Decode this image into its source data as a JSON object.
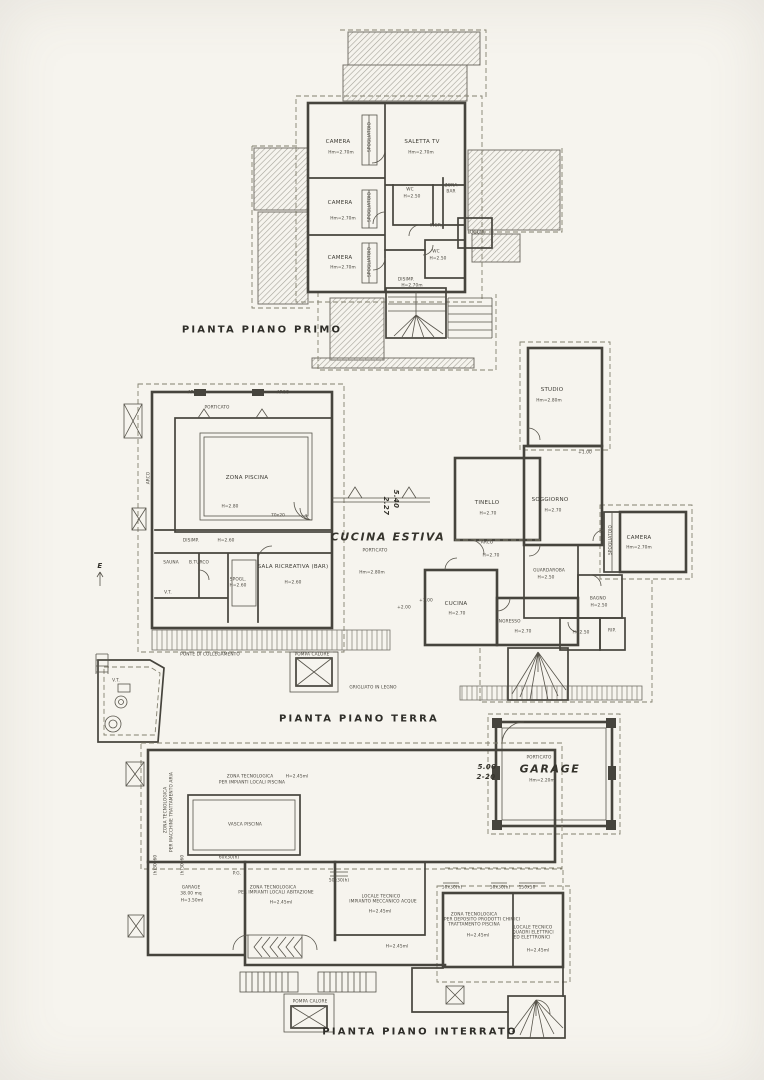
{
  "sheet": {
    "kind": "scanned architectural floor plan drawing",
    "colors": {
      "paper": "#f6f4ee",
      "ink": "#46443d",
      "dash": "#83806f",
      "hatch": "#a5a299"
    }
  },
  "plans": {
    "primo": {
      "title": "PIANTA PIANO PRIMO",
      "labels": [
        {
          "n": "room-camera-1",
          "t": "CAMERA",
          "x": 338,
          "y": 142
        },
        {
          "n": "room-camera-1-height",
          "t": "Hm=2.70m",
          "x": 341,
          "y": 153,
          "cls": "t4"
        },
        {
          "n": "room-saletta-tv",
          "t": "SALETTA  TV",
          "x": 422,
          "y": 142
        },
        {
          "n": "room-saletta-tv-height",
          "t": "Hm=2.70m",
          "x": 421,
          "y": 153,
          "cls": "t4"
        },
        {
          "n": "room-spogliatoio-1",
          "t": "SPOGLIATOIO",
          "x": 370,
          "y": 137,
          "cls": "t4",
          "r": -90
        },
        {
          "n": "room-camera-2",
          "t": "CAMERA",
          "x": 340,
          "y": 203
        },
        {
          "n": "room-camera-2-height",
          "t": "Hm=2.70m",
          "x": 343,
          "y": 219,
          "cls": "t4"
        },
        {
          "n": "room-spogliatoio-2",
          "t": "SPOGLIATOIO",
          "x": 370,
          "y": 207,
          "cls": "t4",
          "r": -90
        },
        {
          "n": "room-wc-1",
          "t": "WC",
          "x": 410,
          "y": 190,
          "cls": "t4"
        },
        {
          "n": "room-wc-1-height",
          "t": "H=2.50",
          "x": 412,
          "y": 197,
          "cls": "t4"
        },
        {
          "n": "room-zona-bar-1",
          "t": "ZONA",
          "x": 451,
          "y": 186,
          "cls": "t4"
        },
        {
          "n": "room-zona-bar-2",
          "t": "BAR",
          "x": 451,
          "y": 192,
          "cls": "t4"
        },
        {
          "n": "room-ingr",
          "t": "INGR.",
          "x": 436,
          "y": 226,
          "cls": "t4"
        },
        {
          "n": "room-loggia",
          "t": "LOGGIA",
          "x": 476,
          "y": 233,
          "cls": "t4"
        },
        {
          "n": "room-camera-3",
          "t": "CAMERA",
          "x": 340,
          "y": 258
        },
        {
          "n": "room-camera-3-height",
          "t": "Hm=2.70m",
          "x": 343,
          "y": 268,
          "cls": "t4"
        },
        {
          "n": "room-spogliatoio-3",
          "t": "SPOGLIATOIO",
          "x": 370,
          "y": 262,
          "cls": "t4",
          "r": -90
        },
        {
          "n": "room-wc-2",
          "t": "WC",
          "x": 436,
          "y": 252,
          "cls": "t4"
        },
        {
          "n": "room-wc-2-height",
          "t": "H=2.50",
          "x": 438,
          "y": 259,
          "cls": "t4"
        },
        {
          "n": "room-disimp",
          "t": "DISIMP.",
          "x": 406,
          "y": 280,
          "cls": "t4"
        },
        {
          "n": "room-disimp-height",
          "t": "H=2.70m",
          "x": 412,
          "y": 286,
          "cls": "t4"
        }
      ]
    },
    "terra": {
      "title": "PIANTA PIANO TERRA",
      "labels": [
        {
          "n": "note-arco-1",
          "t": "ARCO",
          "x": 194,
          "y": 393,
          "cls": "t4"
        },
        {
          "n": "note-arco-2",
          "t": "ARCO",
          "x": 283,
          "y": 393,
          "cls": "t4"
        },
        {
          "n": "note-arco-left",
          "t": "ARCO",
          "x": 149,
          "y": 478,
          "cls": "t4",
          "r": -90
        },
        {
          "n": "note-porticato-piscina",
          "t": "PORTICATO",
          "x": 217,
          "y": 408,
          "cls": "t4"
        },
        {
          "n": "room-zona-piscina",
          "t": "ZONA PISCINA",
          "x": 247,
          "y": 478
        },
        {
          "n": "room-zona-piscina-height",
          "t": "H=2.80",
          "x": 230,
          "y": 507,
          "cls": "t4"
        },
        {
          "n": "dim-pool-step",
          "t": "70x20",
          "x": 278,
          "y": 516,
          "cls": "t4"
        },
        {
          "n": "room-disimp-terra",
          "t": "DISIMP.",
          "x": 191,
          "y": 541,
          "cls": "t4"
        },
        {
          "n": "room-disimp-terra-height",
          "t": "H=2.60",
          "x": 226,
          "y": 541,
          "cls": "t4"
        },
        {
          "n": "room-sauna",
          "t": "SAUNA",
          "x": 171,
          "y": 563,
          "cls": "t4"
        },
        {
          "n": "room-bagno-turco",
          "t": "B.TURCO",
          "x": 199,
          "y": 563,
          "cls": "t4"
        },
        {
          "n": "room-spogl",
          "t": "SPOGL.",
          "x": 238,
          "y": 580,
          "cls": "t4"
        },
        {
          "n": "room-spogl-height",
          "t": "H=2.60",
          "x": 238,
          "y": 586,
          "cls": "t4"
        },
        {
          "n": "room-sala-ricreativa",
          "t": "SALA  RICREATIVA  (BAR)",
          "x": 293,
          "y": 567
        },
        {
          "n": "room-sala-ricreativa-height",
          "t": "H=2.60",
          "x": 293,
          "y": 583,
          "cls": "t4"
        },
        {
          "n": "note-vt-locale",
          "t": "V.T.",
          "x": 168,
          "y": 593,
          "cls": "t4"
        },
        {
          "n": "note-ponte",
          "t": "PONTE  DI  COLLEGAMENTO",
          "x": 210,
          "y": 655,
          "cls": "t4"
        },
        {
          "n": "note-vt-outbuilding",
          "t": "V.T.",
          "x": 116,
          "y": 681,
          "cls": "t4"
        },
        {
          "n": "hand-cucina-estiva",
          "t": "CUCINA ESTIVA",
          "x": 388,
          "y": 537,
          "cls": "hand"
        },
        {
          "n": "note-porticato-cucina",
          "t": "PORTICATO",
          "x": 375,
          "y": 551,
          "cls": "t4"
        },
        {
          "n": "note-porticato-cucina-height",
          "t": "Hm=2.80m",
          "x": 372,
          "y": 573,
          "cls": "t4"
        },
        {
          "n": "hand-dim-540",
          "t": "5.40",
          "x": 396,
          "y": 499,
          "cls": "hand-s",
          "r": 90
        },
        {
          "n": "hand-dim-227",
          "t": "2.27",
          "x": 386,
          "y": 506,
          "cls": "hand-s",
          "r": 90
        },
        {
          "n": "room-tinello",
          "t": "TINELLO",
          "x": 487,
          "y": 503
        },
        {
          "n": "room-tinello-height",
          "t": "H=2.70",
          "x": 488,
          "y": 514,
          "cls": "t4"
        },
        {
          "n": "note-arco-tinello",
          "t": "ARCO",
          "x": 487,
          "y": 543,
          "cls": "t4"
        },
        {
          "n": "note-arco-tinello-height",
          "t": "H=2.70",
          "x": 491,
          "y": 556,
          "cls": "t4"
        },
        {
          "n": "room-studio",
          "t": "STUDIO",
          "x": 552,
          "y": 390
        },
        {
          "n": "room-studio-height",
          "t": "Hm=2.80m",
          "x": 549,
          "y": 401,
          "cls": "t4"
        },
        {
          "n": "room-soggiorno",
          "t": "SOGGIORNO",
          "x": 550,
          "y": 500
        },
        {
          "n": "room-soggiorno-height",
          "t": "H=2.70",
          "x": 553,
          "y": 511,
          "cls": "t4"
        },
        {
          "n": "room-camera-terra",
          "t": "CAMERA",
          "x": 639,
          "y": 538
        },
        {
          "n": "room-camera-terra-height",
          "t": "Hm=2.70m",
          "x": 639,
          "y": 548,
          "cls": "t4"
        },
        {
          "n": "room-spogliatoio-terra",
          "t": "SPOGLIATOIO",
          "x": 611,
          "y": 540,
          "cls": "t4",
          "r": -90
        },
        {
          "n": "room-guardaroba",
          "t": "GUARDAROBA",
          "x": 549,
          "y": 571,
          "cls": "t4"
        },
        {
          "n": "room-guardaroba-height",
          "t": "H=2.50",
          "x": 546,
          "y": 578,
          "cls": "t4"
        },
        {
          "n": "room-bagno",
          "t": "BAGNO",
          "x": 598,
          "y": 599,
          "cls": "t4"
        },
        {
          "n": "room-bagno-height",
          "t": "H=2.50",
          "x": 599,
          "y": 606,
          "cls": "t4"
        },
        {
          "n": "room-wc-terra-height",
          "t": "H=2.50",
          "x": 581,
          "y": 633,
          "cls": "t4"
        },
        {
          "n": "room-rip",
          "t": "RIP.",
          "x": 612,
          "y": 631,
          "cls": "t4"
        },
        {
          "n": "room-cucina",
          "t": "CUCINA",
          "x": 456,
          "y": 604
        },
        {
          "n": "room-cucina-height",
          "t": "H=2.70",
          "x": 457,
          "y": 614,
          "cls": "t4"
        },
        {
          "n": "room-ingresso",
          "t": "INGRESSO",
          "x": 509,
          "y": 622,
          "cls": "t4"
        },
        {
          "n": "room-ingresso-height",
          "t": "H=2.70",
          "x": 523,
          "y": 632,
          "cls": "t4"
        },
        {
          "n": "level-plus-100",
          "t": "+1.00",
          "x": 426,
          "y": 601,
          "cls": "t4"
        },
        {
          "n": "level-plus-200",
          "t": "+2.00",
          "x": 404,
          "y": 608,
          "cls": "t4"
        },
        {
          "n": "level-plus-100-b",
          "t": "+1.00",
          "x": 585,
          "y": 453,
          "cls": "t4"
        },
        {
          "n": "note-pompa-calore",
          "t": "POMPA CALORE",
          "x": 312,
          "y": 655,
          "cls": "t4"
        },
        {
          "n": "note-grigliato",
          "t": "GRIGLIATO  IN  LEGNO",
          "x": 373,
          "y": 688,
          "cls": "t4"
        },
        {
          "n": "hand-east-mark",
          "t": "E",
          "x": 100,
          "y": 566,
          "cls": "hand-s"
        },
        {
          "n": "note-porticato-garage",
          "t": "PORTICATO",
          "x": 539,
          "y": 758,
          "cls": "t4"
        },
        {
          "n": "hand-garage",
          "t": "GARAGE",
          "x": 550,
          "y": 769,
          "cls": "hand"
        },
        {
          "n": "note-garage-height",
          "t": "Hm=2.20m",
          "x": 542,
          "y": 781,
          "cls": "t4"
        },
        {
          "n": "hand-dim-500",
          "t": "5.00",
          "x": 487,
          "y": 767,
          "cls": "hand-s"
        },
        {
          "n": "hand-dim-220",
          "t": "2-20",
          "x": 486,
          "y": 777,
          "cls": "hand-s"
        }
      ]
    },
    "interrato": {
      "title": "PIANTA PIANO INTERRATO",
      "labels": [
        {
          "n": "room-zt-piscina-1",
          "t": "ZONA TECNOLOGICA",
          "x": 250,
          "y": 777,
          "cls": "t4"
        },
        {
          "n": "room-zt-piscina-2",
          "t": "PER IMPIANTI LOCALI PISCINA",
          "x": 252,
          "y": 783,
          "cls": "t4"
        },
        {
          "n": "room-zt-piscina-height",
          "t": "H=2.45ml",
          "x": 297,
          "y": 777,
          "cls": "t4"
        },
        {
          "n": "room-vasca-piscina",
          "t": "VASCA  PISCINA",
          "x": 245,
          "y": 825,
          "cls": "t4"
        },
        {
          "n": "room-zt-aria-1",
          "t": "ZONA TECNOLOGICA",
          "x": 166,
          "y": 810,
          "cls": "t4",
          "r": -90
        },
        {
          "n": "room-zt-aria-2",
          "t": "PER MACCHINE TRATTAMENTO ARIA",
          "x": 172,
          "y": 812,
          "cls": "t4",
          "r": -90
        },
        {
          "n": "room-garage-interrato",
          "t": "GARAGE",
          "x": 191,
          "y": 888,
          "cls": "t4"
        },
        {
          "n": "room-garage-interrato-mq",
          "t": "38.00 mq",
          "x": 191,
          "y": 894,
          "cls": "t4"
        },
        {
          "n": "room-garage-interrato-height",
          "t": "H=3.50ml",
          "x": 192,
          "y": 901,
          "cls": "t4"
        },
        {
          "n": "dim-60x30",
          "t": "60x30(h)",
          "x": 229,
          "y": 858,
          "cls": "t4"
        },
        {
          "n": "dim-pg",
          "t": "P.G.",
          "x": 237,
          "y": 874,
          "cls": "t4"
        },
        {
          "n": "dim-30x60-1",
          "t": "(h)30x60",
          "x": 156,
          "y": 865,
          "cls": "t4",
          "r": -90
        },
        {
          "n": "dim-30x60-2",
          "t": "(h)30x60",
          "x": 183,
          "y": 865,
          "cls": "t4",
          "r": -90
        },
        {
          "n": "room-zt-abitazione-1",
          "t": "ZONA TECNOLOGICA",
          "x": 273,
          "y": 888,
          "cls": "t4"
        },
        {
          "n": "room-zt-abitazione-2",
          "t": "PER IMPIANTI LOCALI ABITAZIONE",
          "x": 276,
          "y": 893,
          "cls": "t4"
        },
        {
          "n": "room-zt-abitazione-height",
          "t": "H=2.45ml",
          "x": 281,
          "y": 903,
          "cls": "t4"
        },
        {
          "n": "room-locale-acque-1",
          "t": "LOCALE TECNICO",
          "x": 381,
          "y": 897,
          "cls": "t4"
        },
        {
          "n": "room-locale-acque-2",
          "t": "IMPIANTO MECCANICO ACQUE",
          "x": 383,
          "y": 902,
          "cls": "t4"
        },
        {
          "n": "room-locale-acque-height",
          "t": "H=2.45ml",
          "x": 380,
          "y": 912,
          "cls": "t4"
        },
        {
          "n": "dim-50x30-a",
          "t": "50x30(h)",
          "x": 339,
          "y": 881,
          "cls": "t4"
        },
        {
          "n": "corridor-height",
          "t": "H=2.45ml",
          "x": 397,
          "y": 947,
          "cls": "t4"
        },
        {
          "n": "dim-50x30-b",
          "t": "50x30(h)",
          "x": 452,
          "y": 888,
          "cls": "t4"
        },
        {
          "n": "dim-50x30-c",
          "t": "50x30(h)",
          "x": 500,
          "y": 888,
          "cls": "t4"
        },
        {
          "n": "dim-150x50",
          "t": "150x50",
          "x": 527,
          "y": 888,
          "cls": "t4"
        },
        {
          "n": "room-zt-chimici-1",
          "t": "ZONA TECNOLOGICA",
          "x": 474,
          "y": 915,
          "cls": "t4"
        },
        {
          "n": "room-zt-chimici-2",
          "t": "PER DEPOSITO PRODOTTI CHIMICI",
          "x": 482,
          "y": 920,
          "cls": "t4"
        },
        {
          "n": "room-zt-chimici-3",
          "t": "TRATTAMENTO PISCINA",
          "x": 474,
          "y": 925,
          "cls": "t4"
        },
        {
          "n": "room-zt-chimici-height",
          "t": "H=2.45ml",
          "x": 478,
          "y": 936,
          "cls": "t4"
        },
        {
          "n": "room-locale-elettrico-1",
          "t": "LOCALE TECNICO",
          "x": 533,
          "y": 928,
          "cls": "t4"
        },
        {
          "n": "room-locale-elettrico-2",
          "t": "QUADRI ELETTRICI",
          "x": 533,
          "y": 933,
          "cls": "t4"
        },
        {
          "n": "room-locale-elettrico-3",
          "t": "ED ELETTRONICI",
          "x": 532,
          "y": 938,
          "cls": "t4"
        },
        {
          "n": "room-locale-elettrico-height",
          "t": "H=2.45ml",
          "x": 538,
          "y": 951,
          "cls": "t4"
        },
        {
          "n": "note-pompa-calore-interrato",
          "t": "POMPA CALORE",
          "x": 310,
          "y": 1002,
          "cls": "t4"
        }
      ]
    }
  }
}
